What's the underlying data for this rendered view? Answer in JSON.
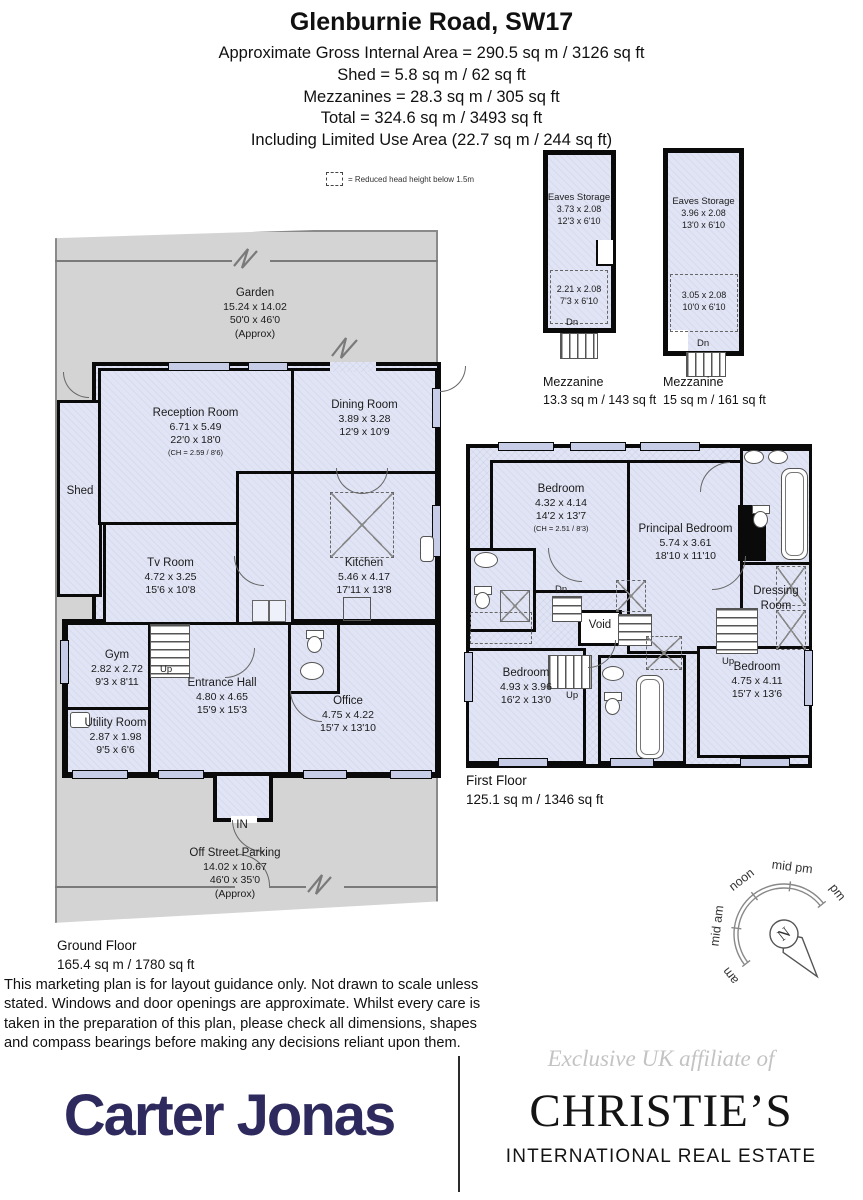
{
  "header": {
    "title": "Glenburnie Road, SW17",
    "lines": [
      "Approximate Gross Internal Area = 290.5 sq m / 3126 sq ft",
      "Shed = 5.8 sq m / 62 sq ft",
      "Mezzanines = 28.3 sq m / 305 sq ft",
      "Total = 324.6 sq m / 3493 sq ft",
      "Including Limited Use Area (22.7 sq m / 244 sq ft)"
    ]
  },
  "legend": {
    "text": "= Reduced head height below 1.5m"
  },
  "labels": {
    "up": "Up",
    "dn": "Dn",
    "in": "IN"
  },
  "ground_floor": {
    "caption_title": "Ground Floor",
    "caption_area": "165.4 sq m / 1780 sq ft",
    "garden": {
      "name": "Garden",
      "dim_m": "15.24 x 14.02",
      "dim_ft": "50'0 x 46'0",
      "approx": "(Approx)"
    },
    "parking": {
      "name": "Off Street Parking",
      "dim_m": "14.02 x 10.67",
      "dim_ft": "46'0 x 35'0",
      "approx": "(Approx)"
    },
    "shed_label": "Shed",
    "rooms": {
      "reception": {
        "name": "Reception Room",
        "dim_m": "6.71 x 5.49",
        "dim_ft": "22'0 x 18'0",
        "note": "(CH = 2.59 / 8'6)"
      },
      "dining": {
        "name": "Dining Room",
        "dim_m": "3.89 x 3.28",
        "dim_ft": "12'9 x 10'9"
      },
      "kitchen": {
        "name": "Kitchen",
        "dim_m": "5.46 x 4.17",
        "dim_ft": "17'11 x 13'8"
      },
      "tv": {
        "name": "Tv Room",
        "dim_m": "4.72 x 3.25",
        "dim_ft": "15'6 x 10'8"
      },
      "gym": {
        "name": "Gym",
        "dim_m": "2.82 x 2.72",
        "dim_ft": "9'3 x 8'11"
      },
      "hall": {
        "name": "Entrance Hall",
        "dim_m": "4.80 x 4.65",
        "dim_ft": "15'9 x 15'3"
      },
      "office": {
        "name": "Office",
        "dim_m": "4.75 x 4.22",
        "dim_ft": "15'7 x 13'10"
      },
      "utility": {
        "name": "Utility Room",
        "dim_m": "2.87 x 1.98",
        "dim_ft": "9'5 x 6'6"
      }
    }
  },
  "mezzanines": [
    {
      "caption_name": "Mezzanine",
      "caption_area": "13.3 sq m / 143 sq ft",
      "eaves": {
        "name": "Eaves Storage",
        "dim_m": "3.73 x 2.08",
        "dim_ft": "12'3 x 6'10"
      },
      "lower": {
        "dim_m": "2.21 x 2.08",
        "dim_ft": "7'3 x 6'10"
      }
    },
    {
      "caption_name": "Mezzanine",
      "caption_area": "15 sq m / 161 sq ft",
      "eaves": {
        "name": "Eaves Storage",
        "dim_m": "3.96 x 2.08",
        "dim_ft": "13'0 x 6'10"
      },
      "lower": {
        "dim_m": "3.05 x 2.08",
        "dim_ft": "10'0 x 6'10"
      }
    }
  ],
  "first_floor": {
    "caption_title": "First Floor",
    "caption_area": "125.1 sq m / 1346 sq ft",
    "rooms": {
      "bedroom_tl": {
        "name": "Bedroom",
        "dim_m": "4.32 x 4.14",
        "dim_ft": "14'2 x 13'7",
        "note": "(CH = 2.51 / 8'3)"
      },
      "principal": {
        "name": "Principal Bedroom",
        "dim_m": "5.74 x 3.61",
        "dim_ft": "18'10 x 11'10"
      },
      "dressing": {
        "name": "Dressing Room"
      },
      "void": {
        "name": "Void"
      },
      "bedroom_bl": {
        "name": "Bedroom",
        "dim_m": "4.93 x 3.96",
        "dim_ft": "16'2 x 13'0"
      },
      "bedroom_br": {
        "name": "Bedroom",
        "dim_m": "4.75 x 4.11",
        "dim_ft": "15'7 x 13'6"
      }
    }
  },
  "compass": {
    "sectors": [
      "am",
      "mid am",
      "noon",
      "mid pm",
      "pm"
    ],
    "north": "N"
  },
  "footer": {
    "disclaimer": "This marketing plan is for layout guidance only. Not drawn to scale unless stated. Windows and door openings are approximate. Whilst every care is taken in the preparation of this plan, please check all dimensions, shapes and compass bearings before making any decisions reliant upon them.",
    "agent_logo": "Carter Jonas",
    "affiliate_line": "Exclusive UK affiliate of",
    "brand": "CHRISTIE’S",
    "brand_sub": "INTERNATIONAL REAL ESTATE"
  },
  "colors": {
    "room_fill": "#e1e4f4",
    "garden_grey": "#d4d4d4",
    "wall": "#0a0a0a",
    "carter_navy": "#2e2a5e",
    "affiliate_grey": "#c3c3c3"
  }
}
